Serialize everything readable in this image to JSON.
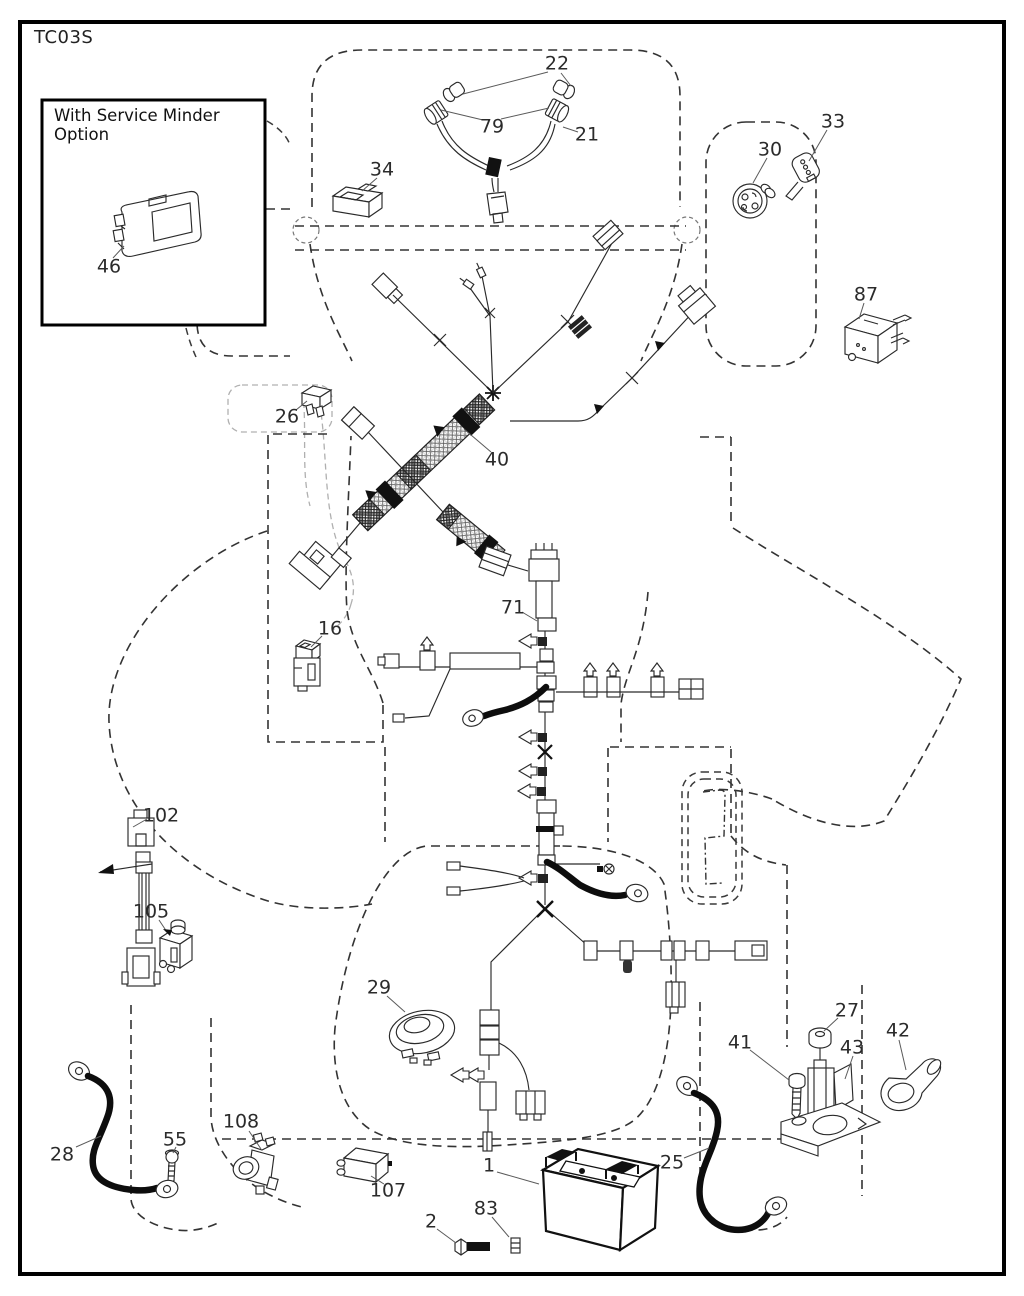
{
  "page": {
    "code": "TC03S"
  },
  "inset": {
    "title": "With Service Minder Option"
  },
  "part_labels": [
    {
      "id": "46",
      "x": 109,
      "y": 267
    },
    {
      "id": "22",
      "x": 557,
      "y": 64
    },
    {
      "id": "79",
      "x": 492,
      "y": 127
    },
    {
      "id": "21",
      "x": 587,
      "y": 135
    },
    {
      "id": "34",
      "x": 382,
      "y": 170
    },
    {
      "id": "30",
      "x": 770,
      "y": 150
    },
    {
      "id": "33",
      "x": 833,
      "y": 122
    },
    {
      "id": "87",
      "x": 866,
      "y": 295
    },
    {
      "id": "26",
      "x": 287,
      "y": 417
    },
    {
      "id": "40",
      "x": 497,
      "y": 460
    },
    {
      "id": "16",
      "x": 330,
      "y": 629
    },
    {
      "id": "71",
      "x": 513,
      "y": 608
    },
    {
      "id": "102",
      "x": 161,
      "y": 816
    },
    {
      "id": "105",
      "x": 151,
      "y": 912
    },
    {
      "id": "29",
      "x": 379,
      "y": 988
    },
    {
      "id": "108",
      "x": 241,
      "y": 1122
    },
    {
      "id": "55",
      "x": 175,
      "y": 1140
    },
    {
      "id": "28",
      "x": 62,
      "y": 1155
    },
    {
      "id": "107",
      "x": 388,
      "y": 1191
    },
    {
      "id": "2",
      "x": 431,
      "y": 1222
    },
    {
      "id": "83",
      "x": 486,
      "y": 1209
    },
    {
      "id": "1",
      "x": 489,
      "y": 1166
    },
    {
      "id": "25",
      "x": 672,
      "y": 1163
    },
    {
      "id": "41",
      "x": 740,
      "y": 1043
    },
    {
      "id": "27",
      "x": 847,
      "y": 1011
    },
    {
      "id": "43",
      "x": 852,
      "y": 1048
    },
    {
      "id": "42",
      "x": 898,
      "y": 1031
    }
  ],
  "colors": {
    "line": "#2a2a2a",
    "dash": "#333333",
    "cable": "#0d0d0d",
    "label": "#2b2b2b",
    "background": "#ffffff"
  }
}
